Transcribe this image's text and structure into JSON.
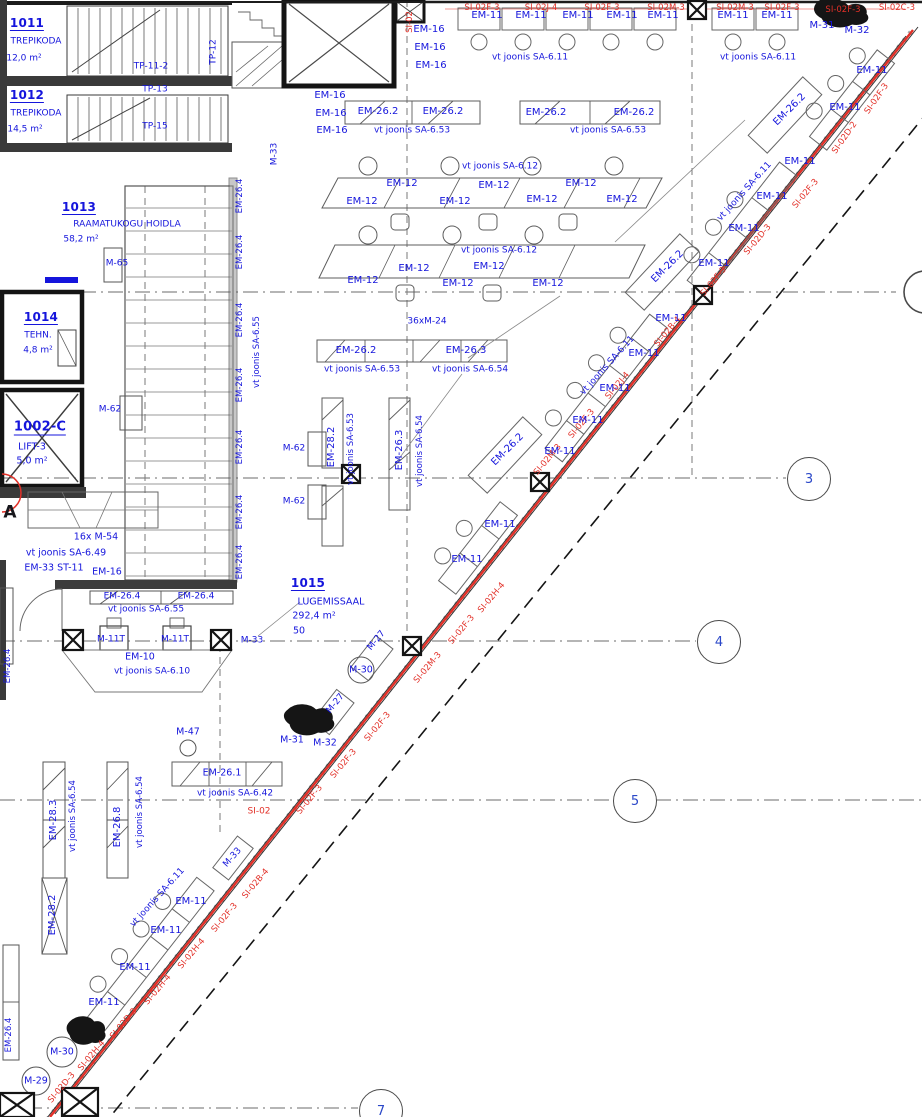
{
  "canvas": {
    "w": 922,
    "h": 1117
  },
  "palette": {
    "cad_blue": "#1515dc",
    "cad_red": "#e23028",
    "line_dark": "#1a1a1a",
    "line_gray": "#6e6e6e"
  },
  "rooms": [
    {
      "number": "1011",
      "name": "TREPIKODA",
      "area": "12,0 m²"
    },
    {
      "number": "1012",
      "name": "TREPIKODA",
      "area": "14,5 m²"
    },
    {
      "number": "1013",
      "name": "RAAMATUKOGU HOIDLA",
      "area": "58,2 m²"
    },
    {
      "number": "1014",
      "name": "TEHN.",
      "area": "4,8 m²"
    },
    {
      "number": "1002-C",
      "name": "LIFT-3",
      "area": "5,0 m²"
    },
    {
      "number": "1015",
      "name": "LUGEMISSAAL",
      "area": "292,4 m²",
      "seats": "50"
    }
  ],
  "grid_bubbles": [
    {
      "label": "3",
      "x": 808,
      "y": 478
    },
    {
      "label": "4",
      "x": 718,
      "y": 641
    },
    {
      "label": "5",
      "x": 634,
      "y": 800
    },
    {
      "label": "7",
      "x": 380,
      "y": 1110
    }
  ],
  "labels": [
    {
      "t": "1011",
      "x": 27,
      "y": 24,
      "fs": 12,
      "b": 1,
      "u": 1,
      "n": "room-number"
    },
    {
      "t": "TREPIKODA",
      "x": 36,
      "y": 42,
      "fs": 9,
      "n": "room-name"
    },
    {
      "t": "12,0 m²",
      "x": 24,
      "y": 59,
      "fs": 9,
      "n": "room-area"
    },
    {
      "t": "TP-11-2",
      "x": 151,
      "y": 67,
      "fs": 9
    },
    {
      "t": "TP-12",
      "x": 214,
      "y": 52,
      "r": -90,
      "fs": 9
    },
    {
      "t": "TP-13",
      "x": 155,
      "y": 90,
      "fs": 9
    },
    {
      "t": "1012",
      "x": 27,
      "y": 96,
      "fs": 12,
      "b": 1,
      "u": 1,
      "n": "room-number"
    },
    {
      "t": "TREPIKODA",
      "x": 36,
      "y": 114,
      "fs": 9,
      "n": "room-name"
    },
    {
      "t": "14,5 m²",
      "x": 25,
      "y": 130,
      "fs": 9,
      "n": "room-area"
    },
    {
      "t": "TP-15",
      "x": 155,
      "y": 127,
      "fs": 9
    },
    {
      "t": "M-33",
      "x": 275,
      "y": 154,
      "r": -90,
      "fs": 9
    },
    {
      "t": "EM-16",
      "x": 429,
      "y": 30
    },
    {
      "t": "EM-16",
      "x": 430,
      "y": 48
    },
    {
      "t": "EM-16",
      "x": 431,
      "y": 66
    },
    {
      "t": "EM-16",
      "x": 330,
      "y": 96
    },
    {
      "t": "EM-16",
      "x": 331,
      "y": 114
    },
    {
      "t": "EM-16",
      "x": 332,
      "y": 131
    },
    {
      "t": "EM-11",
      "x": 487,
      "y": 16
    },
    {
      "t": "EM-11",
      "x": 531,
      "y": 16
    },
    {
      "t": "EM-11",
      "x": 578,
      "y": 16
    },
    {
      "t": "EM-11",
      "x": 622,
      "y": 16
    },
    {
      "t": "EM-11",
      "x": 663,
      "y": 16
    },
    {
      "t": "EM-11",
      "x": 733,
      "y": 16
    },
    {
      "t": "EM-11",
      "x": 777,
      "y": 16
    },
    {
      "t": "vt joonis SA-6.11",
      "x": 530,
      "y": 58,
      "fs": 9
    },
    {
      "t": "vt joonis SA-6.11",
      "x": 758,
      "y": 58,
      "fs": 9
    },
    {
      "t": "M-31",
      "x": 822,
      "y": 26
    },
    {
      "t": "M-32",
      "x": 857,
      "y": 31
    },
    {
      "t": "SI-02F-3",
      "x": 482,
      "y": 8,
      "c": "r",
      "fs": 8.5
    },
    {
      "t": "SI-02J-4",
      "x": 541,
      "y": 8,
      "c": "r",
      "fs": 8.5
    },
    {
      "t": "SI-02F-3",
      "x": 602,
      "y": 8,
      "c": "r",
      "fs": 8.5
    },
    {
      "t": "SI-02M-3",
      "x": 666,
      "y": 8,
      "c": "r",
      "fs": 8.5
    },
    {
      "t": "SI-02M-3",
      "x": 735,
      "y": 8,
      "c": "r",
      "fs": 8.5
    },
    {
      "t": "SI-02F-3",
      "x": 782,
      "y": 8,
      "c": "r",
      "fs": 8.5
    },
    {
      "t": "SI-02F-3",
      "x": 843,
      "y": 10,
      "c": "r",
      "fs": 8.5
    },
    {
      "t": "SI-02C-3",
      "x": 897,
      "y": 8,
      "c": "r",
      "fs": 8.5
    },
    {
      "t": "SI-02",
      "x": 410,
      "y": 22,
      "r": -90,
      "c": "r",
      "fs": 8.5
    },
    {
      "t": "EM-26.2",
      "x": 378,
      "y": 112
    },
    {
      "t": "EM-26.2",
      "x": 443,
      "y": 112
    },
    {
      "t": "EM-26.2",
      "x": 546,
      "y": 113
    },
    {
      "t": "EM-26.2",
      "x": 634,
      "y": 113
    },
    {
      "t": "vt joonis SA-6.53",
      "x": 412,
      "y": 131,
      "fs": 9
    },
    {
      "t": "vt joonis SA-6.53",
      "x": 608,
      "y": 131,
      "fs": 9
    },
    {
      "t": "vt joonis SA-6.12",
      "x": 500,
      "y": 167,
      "fs": 9
    },
    {
      "t": "EM-12",
      "x": 402,
      "y": 184
    },
    {
      "t": "EM-12",
      "x": 362,
      "y": 202
    },
    {
      "t": "EM-12",
      "x": 494,
      "y": 186
    },
    {
      "t": "EM-12",
      "x": 455,
      "y": 202
    },
    {
      "t": "EM-12",
      "x": 581,
      "y": 184
    },
    {
      "t": "EM-12",
      "x": 542,
      "y": 200
    },
    {
      "t": "EM-12",
      "x": 622,
      "y": 200
    },
    {
      "t": "vt joonis SA-6.12",
      "x": 499,
      "y": 251,
      "fs": 9
    },
    {
      "t": "EM-12",
      "x": 414,
      "y": 269
    },
    {
      "t": "EM-12",
      "x": 363,
      "y": 281
    },
    {
      "t": "EM-12",
      "x": 489,
      "y": 267
    },
    {
      "t": "EM-12",
      "x": 458,
      "y": 284
    },
    {
      "t": "EM-12",
      "x": 548,
      "y": 284
    },
    {
      "t": "36xM-24",
      "x": 427,
      "y": 322,
      "fs": 9
    },
    {
      "t": "1013",
      "x": 79,
      "y": 208,
      "fs": 12,
      "b": 1,
      "u": 1,
      "n": "room-number"
    },
    {
      "t": "RAAMATUKOGU HOIDLA",
      "x": 127,
      "y": 225,
      "fs": 9,
      "n": "room-name"
    },
    {
      "t": "58,2 m²",
      "x": 81,
      "y": 240,
      "fs": 9,
      "n": "room-area"
    },
    {
      "t": "M-65",
      "x": 117,
      "y": 264,
      "fs": 9
    },
    {
      "t": "EM-26.4",
      "x": 240,
      "y": 196,
      "r": -90,
      "fs": 8.5
    },
    {
      "t": "EM-26.4",
      "x": 240,
      "y": 252,
      "r": -90,
      "fs": 8.5
    },
    {
      "t": "EM-26.4",
      "x": 240,
      "y": 320,
      "r": -90,
      "fs": 8.5
    },
    {
      "t": "EM-26.4",
      "x": 240,
      "y": 385,
      "r": -90,
      "fs": 8.5
    },
    {
      "t": "EM-26.4",
      "x": 240,
      "y": 447,
      "r": -90,
      "fs": 8.5
    },
    {
      "t": "EM-26.4",
      "x": 240,
      "y": 512,
      "r": -90,
      "fs": 8.5
    },
    {
      "t": "EM-26.4",
      "x": 240,
      "y": 562,
      "r": -90,
      "fs": 8.5
    },
    {
      "t": "vt joonis SA-6.55",
      "x": 257,
      "y": 352,
      "r": -90,
      "fs": 8.5
    },
    {
      "t": "EM-26.2",
      "x": 356,
      "y": 351
    },
    {
      "t": "EM-26.3",
      "x": 466,
      "y": 351
    },
    {
      "t": "vt joonis SA-6.53",
      "x": 362,
      "y": 370,
      "fs": 9
    },
    {
      "t": "vt joonis SA-6.54",
      "x": 470,
      "y": 370,
      "fs": 9
    },
    {
      "t": "EM-28.2",
      "x": 332,
      "y": 447,
      "r": -90
    },
    {
      "t": "vt joonis SA-6.53",
      "x": 351,
      "y": 449,
      "r": -90,
      "fs": 8.5
    },
    {
      "t": "EM-26.3",
      "x": 400,
      "y": 450,
      "r": -90
    },
    {
      "t": "vt joonis SA-6.54",
      "x": 420,
      "y": 451,
      "r": -90,
      "fs": 8.5
    },
    {
      "t": "M-62",
      "x": 110,
      "y": 410,
      "fs": 9
    },
    {
      "t": "M-62",
      "x": 294,
      "y": 449,
      "fs": 9
    },
    {
      "t": "M-62",
      "x": 294,
      "y": 502,
      "fs": 9
    },
    {
      "t": "1014",
      "x": 41,
      "y": 318,
      "fs": 12,
      "b": 1,
      "u": 1,
      "n": "room-number"
    },
    {
      "t": "TEHN.",
      "x": 38,
      "y": 336,
      "fs": 9,
      "n": "room-name"
    },
    {
      "t": "4,8 m²",
      "x": 38,
      "y": 351,
      "fs": 9,
      "n": "room-area"
    },
    {
      "t": "1002-C",
      "x": 40,
      "y": 428,
      "fs": 13,
      "b": 1,
      "u": 1,
      "n": "room-number"
    },
    {
      "t": "LIFT-3",
      "x": 32,
      "y": 447,
      "fs": 9.5,
      "n": "room-name"
    },
    {
      "t": "5,0 m²",
      "x": 32,
      "y": 461,
      "fs": 9.5,
      "n": "room-area"
    },
    {
      "t": "A",
      "x": 10,
      "y": 513,
      "fs": 17,
      "b": 1,
      "c": "d",
      "n": "grid-letter-a"
    },
    {
      "t": "16x M-54",
      "x": 96,
      "y": 537,
      "fs": 9.5
    },
    {
      "t": "vt joonis SA-6.49",
      "x": 66,
      "y": 553,
      "fs": 9.5
    },
    {
      "t": "EM-33 ST-11",
      "x": 54,
      "y": 568,
      "fs": 9.5
    },
    {
      "t": "EM-16",
      "x": 107,
      "y": 572,
      "fs": 9.5
    },
    {
      "t": "EM-26.4",
      "x": 122,
      "y": 597,
      "fs": 9
    },
    {
      "t": "EM-26.4",
      "x": 196,
      "y": 597,
      "fs": 9
    },
    {
      "t": "vt joonis SA-6.55",
      "x": 146,
      "y": 610,
      "fs": 9
    },
    {
      "t": "M-11T",
      "x": 111,
      "y": 640,
      "fs": 9
    },
    {
      "t": "M-11T",
      "x": 175,
      "y": 640,
      "fs": 9
    },
    {
      "t": "M-33",
      "x": 252,
      "y": 641,
      "fs": 9
    },
    {
      "t": "EM-10",
      "x": 140,
      "y": 657,
      "fs": 9.5
    },
    {
      "t": "vt joonis SA-6.10",
      "x": 152,
      "y": 672,
      "fs": 9
    },
    {
      "t": "EM-26.4",
      "x": 8,
      "y": 666,
      "r": -90,
      "fs": 8.5
    },
    {
      "t": "1015",
      "x": 308,
      "y": 584,
      "fs": 12,
      "b": 1,
      "u": 1,
      "n": "room-number"
    },
    {
      "t": "LUGEMISSAAL",
      "x": 331,
      "y": 602,
      "fs": 9.5,
      "n": "room-name"
    },
    {
      "t": "292,4 m²",
      "x": 314,
      "y": 616,
      "fs": 9.5,
      "n": "room-area"
    },
    {
      "t": "50",
      "x": 299,
      "y": 631,
      "fs": 9.5,
      "n": "room-seats"
    },
    {
      "t": "M-27",
      "x": 377,
      "y": 641,
      "r": -50,
      "fs": 9
    },
    {
      "t": "M-30",
      "x": 361,
      "y": 670,
      "fs": 9.5
    },
    {
      "t": "M-27",
      "x": 336,
      "y": 704,
      "r": -50,
      "fs": 9
    },
    {
      "t": "M-31",
      "x": 292,
      "y": 740,
      "fs": 9.5
    },
    {
      "t": "M-32",
      "x": 325,
      "y": 743,
      "fs": 9.5
    },
    {
      "t": "M-47",
      "x": 188,
      "y": 732,
      "fs": 9.5
    },
    {
      "t": "EM-26.1",
      "x": 222,
      "y": 773,
      "fs": 9.5
    },
    {
      "t": "vt joonis SA-6.42",
      "x": 235,
      "y": 794,
      "fs": 9
    },
    {
      "t": "SI-02",
      "x": 259,
      "y": 812,
      "c": "r",
      "fs": 9
    },
    {
      "t": "EM-28.3",
      "x": 54,
      "y": 820,
      "r": -90
    },
    {
      "t": "vt joonis SA-6.54",
      "x": 73,
      "y": 816,
      "r": -90,
      "fs": 8.5
    },
    {
      "t": "EM-26.8",
      "x": 118,
      "y": 827,
      "r": -90
    },
    {
      "t": "vt joonis SA-6.54",
      "x": 140,
      "y": 812,
      "r": -90,
      "fs": 8.5
    },
    {
      "t": "EM-28.2",
      "x": 53,
      "y": 915,
      "r": -90
    },
    {
      "t": "EM-26.4",
      "x": 9,
      "y": 1035,
      "r": -90,
      "fs": 8.5
    },
    {
      "t": "vt joonis SA-6.11",
      "x": 158,
      "y": 898,
      "r": -48,
      "fs": 9
    },
    {
      "t": "M-33",
      "x": 233,
      "y": 858,
      "r": -48,
      "fs": 9
    },
    {
      "t": "EM-11",
      "x": 191,
      "y": 902
    },
    {
      "t": "EM-11",
      "x": 166,
      "y": 931
    },
    {
      "t": "EM-11",
      "x": 135,
      "y": 968
    },
    {
      "t": "EM-11",
      "x": 104,
      "y": 1003
    },
    {
      "t": "M-30",
      "x": 62,
      "y": 1052,
      "fs": 9.5
    },
    {
      "t": "M-29",
      "x": 36,
      "y": 1081,
      "fs": 9.5
    },
    {
      "t": "SI-02B-4",
      "x": 256,
      "y": 884,
      "r": -50,
      "c": "r",
      "fs": 8.5
    },
    {
      "t": "SI-02F-3",
      "x": 225,
      "y": 918,
      "r": -50,
      "c": "r",
      "fs": 8.5
    },
    {
      "t": "SI-02H-4",
      "x": 192,
      "y": 954,
      "r": -50,
      "c": "r",
      "fs": 8.5
    },
    {
      "t": "SI-02H-4",
      "x": 158,
      "y": 990,
      "r": -50,
      "c": "r",
      "fs": 8.5
    },
    {
      "t": "SI-02D-3",
      "x": 124,
      "y": 1024,
      "r": -50,
      "c": "r",
      "fs": 8.5
    },
    {
      "t": "SI-02H-4",
      "x": 92,
      "y": 1056,
      "r": -50,
      "c": "r",
      "fs": 8.5
    },
    {
      "t": "SI-02D-3",
      "x": 62,
      "y": 1088,
      "r": -50,
      "c": "r",
      "fs": 8.5
    },
    {
      "t": "SI-02F-3",
      "x": 310,
      "y": 800,
      "r": -50,
      "c": "r",
      "fs": 8.5
    },
    {
      "t": "SI-02F-3",
      "x": 344,
      "y": 764,
      "r": -50,
      "c": "r",
      "fs": 8.5
    },
    {
      "t": "SI-02F-3",
      "x": 378,
      "y": 727,
      "r": -50,
      "c": "r",
      "fs": 8.5
    },
    {
      "t": "SI-02M-3",
      "x": 428,
      "y": 668,
      "r": -50,
      "c": "r",
      "fs": 8.5
    },
    {
      "t": "SI-02F-3",
      "x": 462,
      "y": 630,
      "r": -50,
      "c": "r",
      "fs": 8.5
    },
    {
      "t": "SI-02H-4",
      "x": 492,
      "y": 598,
      "r": -50,
      "c": "r",
      "fs": 8.5
    },
    {
      "t": "SI-02M-3",
      "x": 548,
      "y": 460,
      "r": -50,
      "c": "r",
      "fs": 8.5
    },
    {
      "t": "SI-02F-3",
      "x": 582,
      "y": 424,
      "r": -50,
      "c": "r",
      "fs": 8.5
    },
    {
      "t": "SI-02J-4",
      "x": 618,
      "y": 386,
      "r": -50,
      "c": "r",
      "fs": 8.5
    },
    {
      "t": "SI-02B-4",
      "x": 668,
      "y": 332,
      "r": -50,
      "c": "r",
      "fs": 8.5
    },
    {
      "t": "SI-02F-3",
      "x": 714,
      "y": 282,
      "r": -50,
      "c": "r",
      "fs": 8.5
    },
    {
      "t": "SI-02D-3",
      "x": 758,
      "y": 240,
      "r": -50,
      "c": "r",
      "fs": 8.5
    },
    {
      "t": "SI-02F-3",
      "x": 806,
      "y": 194,
      "r": -50,
      "c": "r",
      "fs": 8.5
    },
    {
      "t": "SI-02D-2",
      "x": 845,
      "y": 138,
      "r": -55,
      "c": "r",
      "fs": 8.5
    },
    {
      "t": "SI-02F-3",
      "x": 877,
      "y": 99,
      "r": -55,
      "c": "r",
      "fs": 8.5
    },
    {
      "t": "EM-11",
      "x": 800,
      "y": 162
    },
    {
      "t": "EM-11",
      "x": 772,
      "y": 197
    },
    {
      "t": "EM-11",
      "x": 744,
      "y": 229
    },
    {
      "t": "EM-11",
      "x": 714,
      "y": 264
    },
    {
      "t": "vt joonis SA-6.11",
      "x": 745,
      "y": 192,
      "r": -48,
      "fs": 9
    },
    {
      "t": "EM-26.2",
      "x": 668,
      "y": 267,
      "r": -45
    },
    {
      "t": "EM-11",
      "x": 872,
      "y": 71
    },
    {
      "t": "EM-11",
      "x": 845,
      "y": 108
    },
    {
      "t": "EM-26.2",
      "x": 790,
      "y": 110,
      "r": -45
    },
    {
      "t": "EM-11",
      "x": 671,
      "y": 319
    },
    {
      "t": "EM-11",
      "x": 644,
      "y": 354
    },
    {
      "t": "EM-11",
      "x": 615,
      "y": 389
    },
    {
      "t": "EM-11",
      "x": 588,
      "y": 421
    },
    {
      "t": "EM-11",
      "x": 560,
      "y": 452
    },
    {
      "t": "vt joonis SA-6.11",
      "x": 608,
      "y": 366,
      "r": -48,
      "fs": 9
    },
    {
      "t": "EM-26.2",
      "x": 508,
      "y": 450,
      "r": -45
    },
    {
      "t": "EM-11",
      "x": 500,
      "y": 525
    },
    {
      "t": "EM-11",
      "x": 467,
      "y": 560
    }
  ]
}
